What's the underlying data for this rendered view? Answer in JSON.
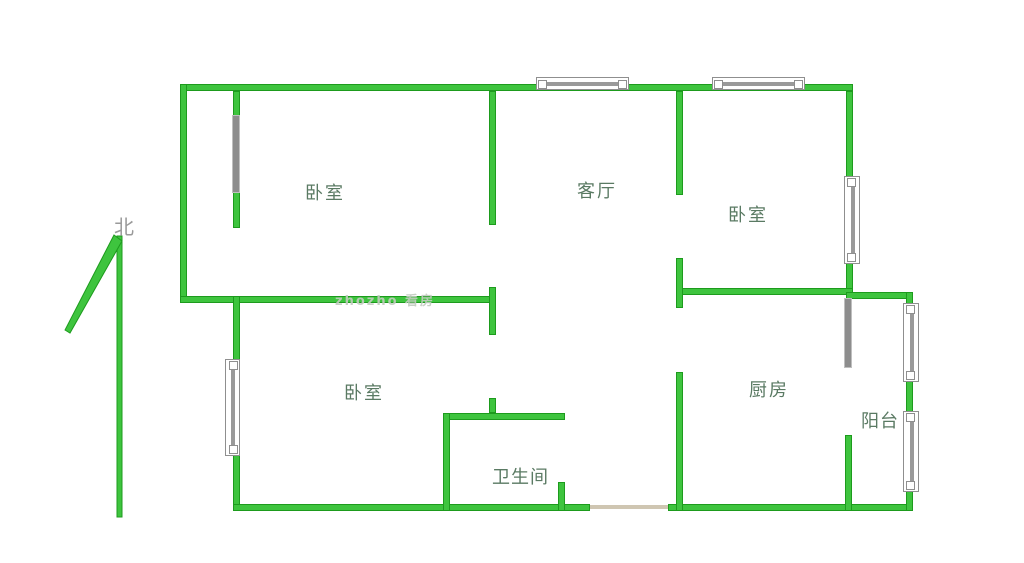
{
  "compass": {
    "label": "北"
  },
  "rooms": {
    "bedroom_top_left": {
      "label": "卧室"
    },
    "living_room": {
      "label": "客厅"
    },
    "bedroom_top_right": {
      "label": "卧室"
    },
    "bedroom_bottom_left": {
      "label": "卧室"
    },
    "bathroom": {
      "label": "卫生间"
    },
    "kitchen": {
      "label": "厨房"
    },
    "balcony": {
      "label": "阳台"
    }
  },
  "watermark": {
    "text": "zhozho 看房"
  },
  "colors": {
    "wall_green": "#3ec43e",
    "wall_border_green": "#1d9b1d",
    "door_gray": "#8d8d8d",
    "window_frame_gray": "#8f8f8f",
    "label_green_gray": "#5a7a63",
    "compass_gray": "#9a9a9a",
    "threshold_tan": "#cfc6b2"
  }
}
